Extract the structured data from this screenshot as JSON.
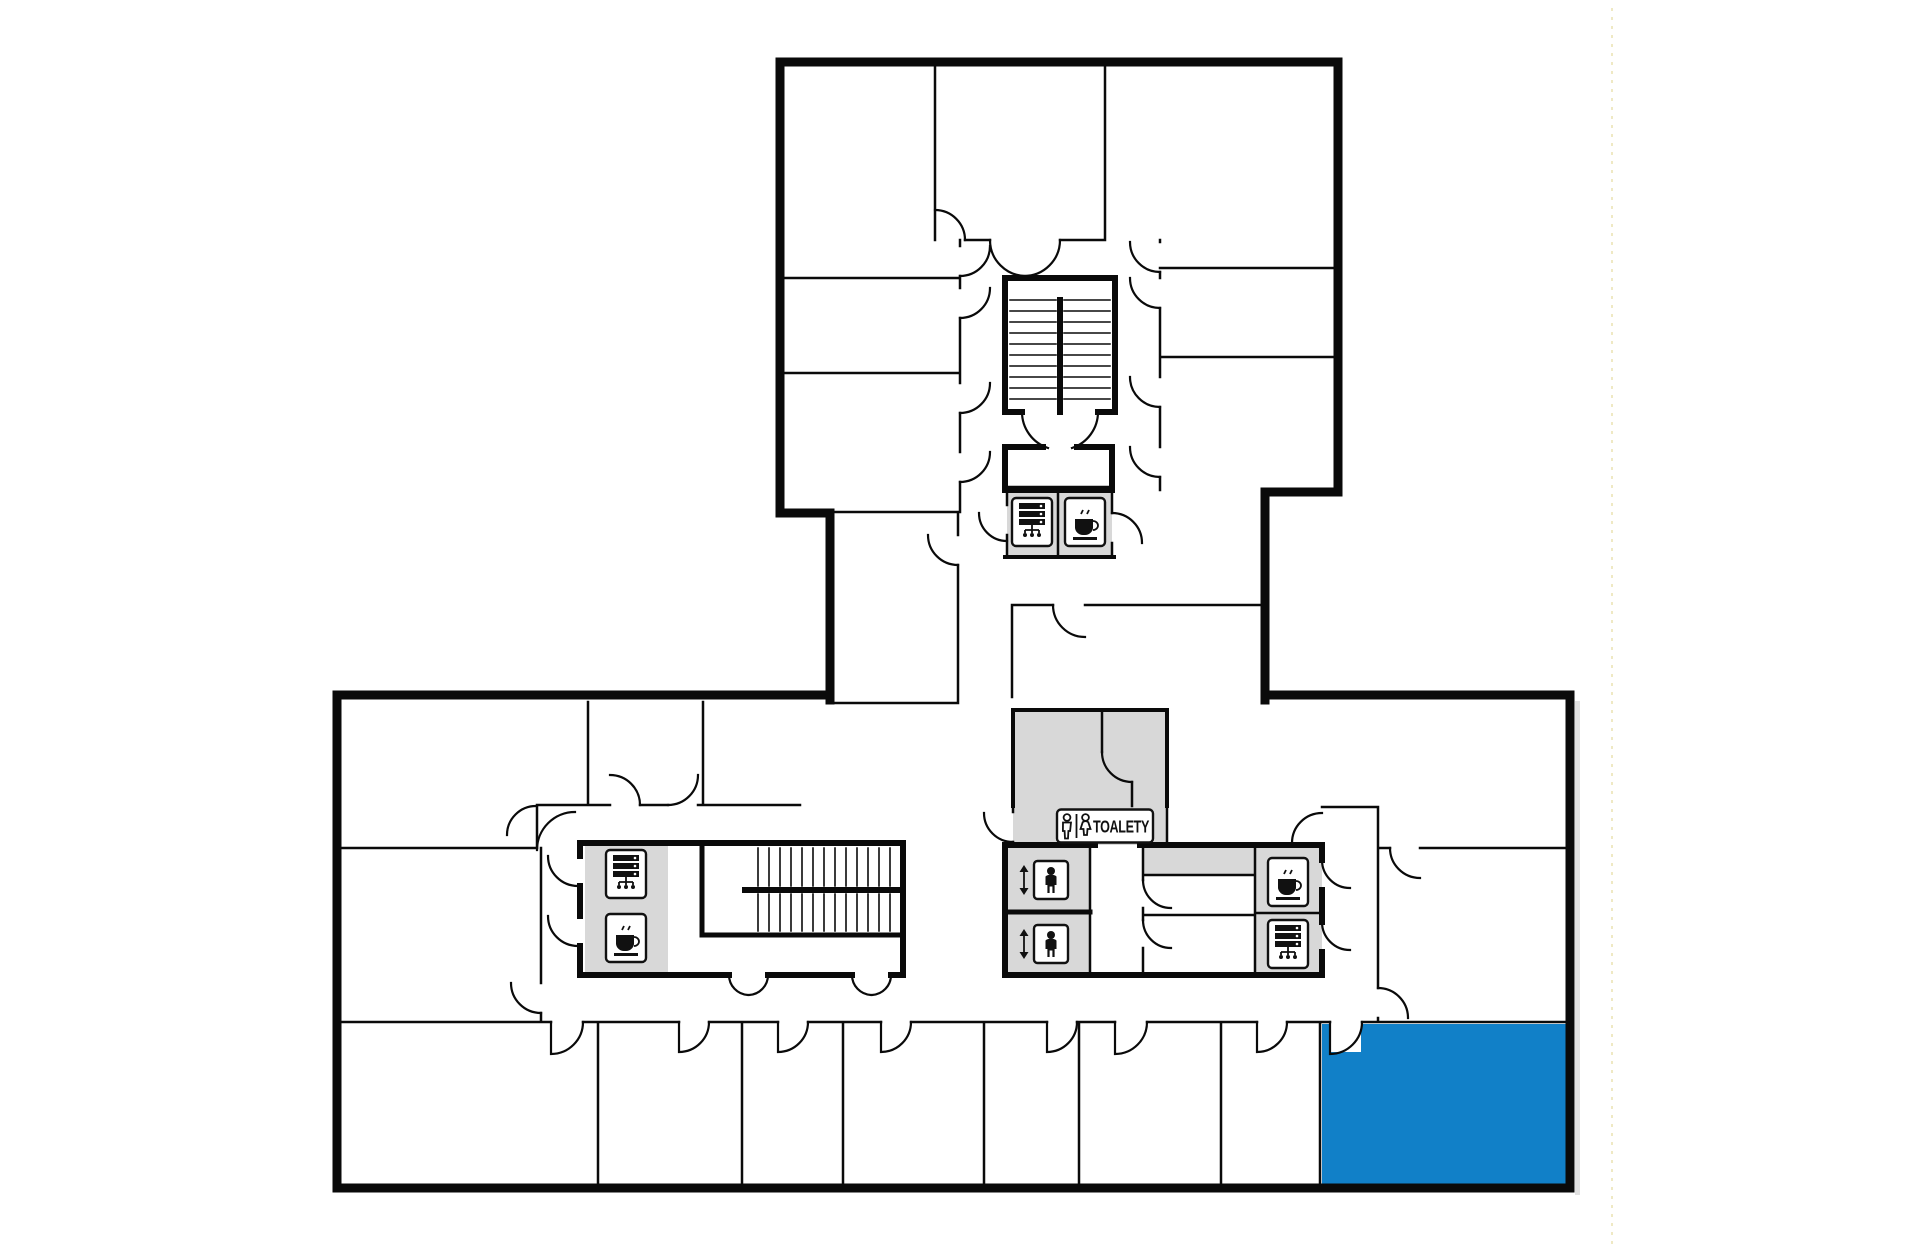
{
  "floor_plan": {
    "toilets_label": "TOALETY",
    "colors": {
      "background": "#ffffff",
      "wall": "#0a0a0a",
      "service_room_fill": "#d8d8d8",
      "highlight_room_fill": "#1180c8",
      "icon_stroke": "#111111",
      "guide_line": "#efe9c4",
      "shadow": "#c8c8c8"
    },
    "icons": {
      "server_room": "server-rack-icon",
      "kitchen": "coffee-cup-icon",
      "elevator": "elevator-icon",
      "toilets_male": "male-icon",
      "toilets_female": "female-icon"
    },
    "rooms": {
      "highlighted_room": "selected-room-bottom-right"
    }
  }
}
